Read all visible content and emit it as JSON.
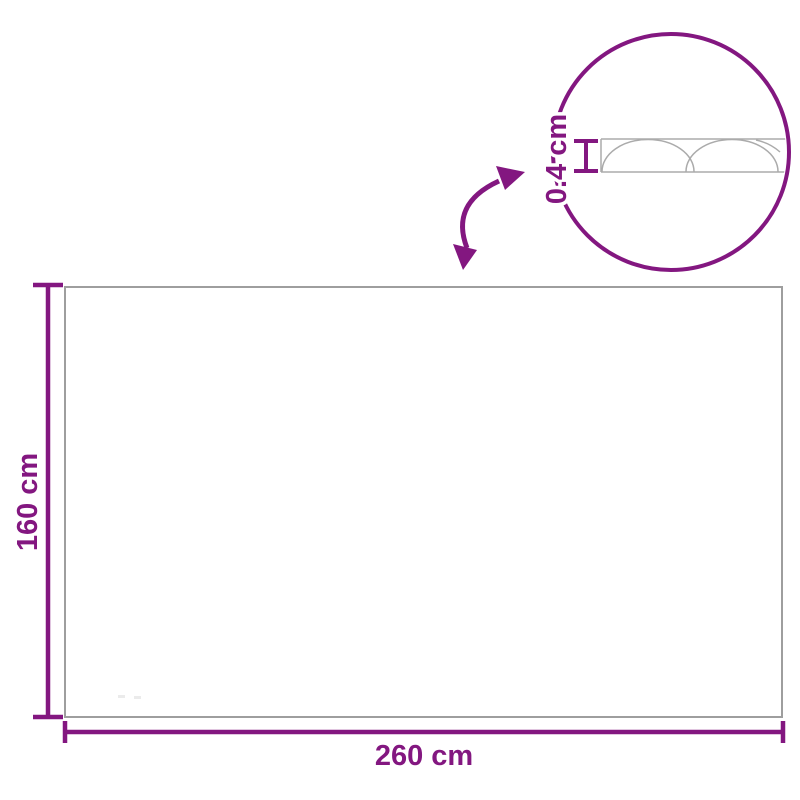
{
  "diagram": {
    "type": "product-dimension-drawing",
    "labels": {
      "width": "260 cm",
      "height": "160 cm",
      "thickness": "0.4 cm"
    },
    "colors": {
      "dimension_purple": "#831780",
      "outline_gray": "#9E9E9E",
      "profile_gray": "#ABABAB",
      "background": "#FFFFFF"
    }
  }
}
